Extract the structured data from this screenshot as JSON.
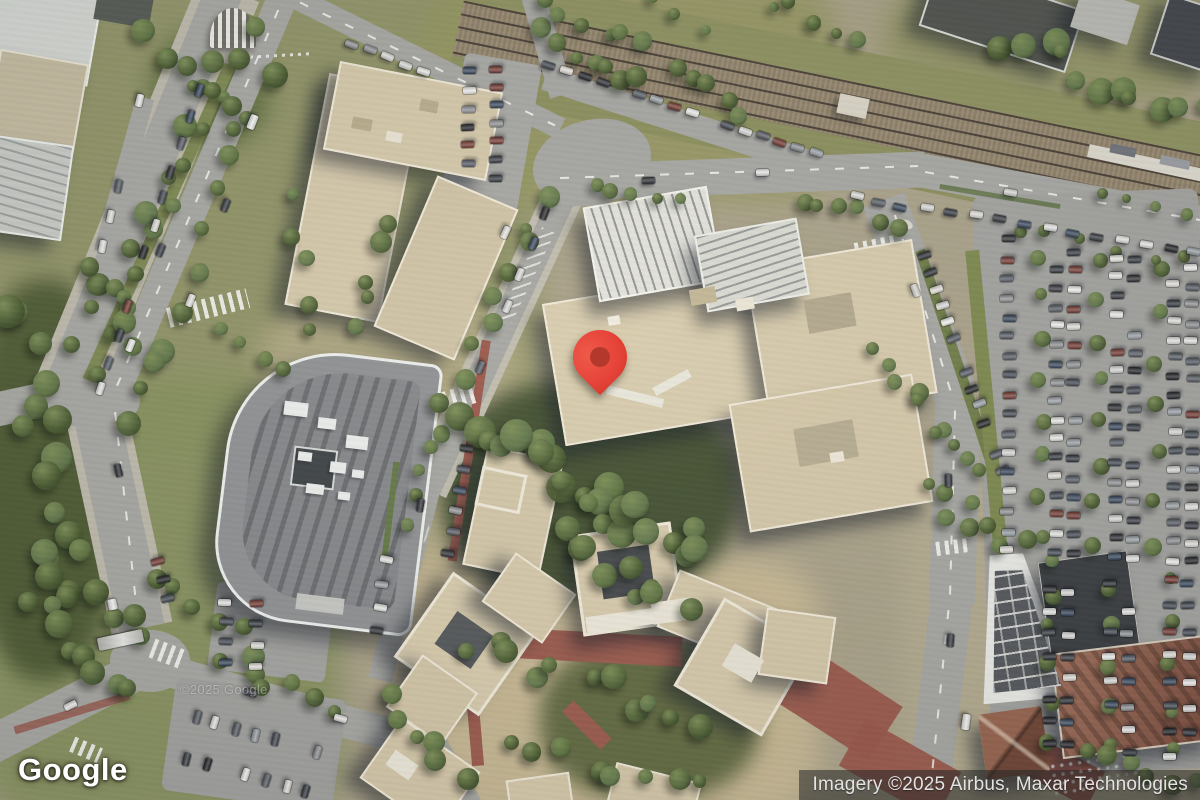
{
  "map": {
    "watermark": "©2025 Google",
    "marker": {
      "type": "location-pin",
      "color": "#E6443A",
      "inner_color": "#B4392C"
    },
    "imagery_colors": {
      "road": "#A6A6A2",
      "building": "#D7CBAD",
      "vegetation": "#4A5C33",
      "railway_ballast": "#95866D",
      "brick_plaza": "#9B5B4E"
    }
  },
  "footer": {
    "logo_text": "Google",
    "attribution": "Imagery ©2025 Airbus, Maxar Technologies"
  }
}
